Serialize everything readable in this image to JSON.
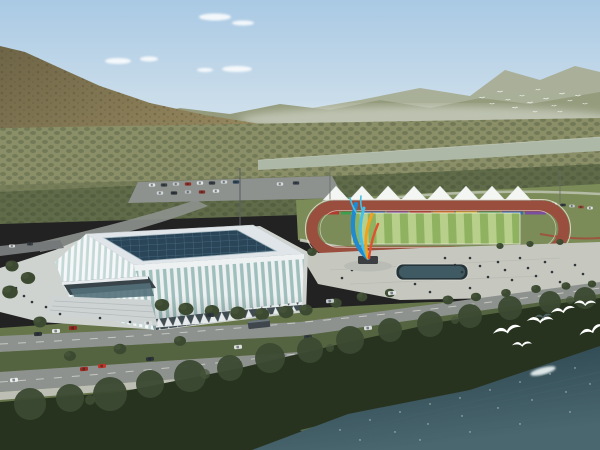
{
  "scene": {
    "type": "aerial-architectural-rendering",
    "subject": "riverside sports complex with gymnasium and outdoor stadium",
    "landmarks": [
      "ribbed-glass-gymnasium",
      "running-track-stadium",
      "white-canopy-tents",
      "flame-ribbon-sculpture",
      "public-plaza",
      "reflecting-pool",
      "parking-lot",
      "lakeside-forest"
    ],
    "environment": [
      "mountain-slope",
      "distant-ridges",
      "valley-forest",
      "river-band",
      "dark-water",
      "sky-with-clouds"
    ],
    "counts": {
      "canopy_tents": 8,
      "billboard_panels": 10,
      "foreground_seagulls": 7,
      "distant_flock_birds": 16
    }
  },
  "colors": {
    "sky_top": "#a9c9e4",
    "sky_horizon": "#edf2f1",
    "cloud": "#ffffff",
    "ridge_far": "#a8ad94",
    "ridge_near": "#959c7e",
    "mountain_light": "#97895f",
    "mountain_dark": "#6e6547",
    "valley": "#8a8f68",
    "valley_dark": "#6d7552",
    "river": "#adb8a6",
    "trees_mid": "#5f6b49",
    "lawn": "#7c8c58",
    "track": "#9a4f3e",
    "field_light": "#b7cf8a",
    "field_dark": "#8fb261",
    "tent": "#f4f6f3",
    "billboard": [
      "#b23b30",
      "#3f9e4d",
      "#2f6fb5",
      "#7a4fa0",
      "#b23b30",
      "#e0872e",
      "#d4c13a",
      "#3f9e4d",
      "#2f6fb5",
      "#7a4fa0"
    ],
    "plaza": "#c6c8c0",
    "pad": "#cfd3d0",
    "road": "#8e928e",
    "road_dark": "#75797a",
    "grass": "#66754a",
    "grass_dark": "#556440",
    "roof": "#dfe5e8",
    "skylight": "#2a4557",
    "glass": "#9fbfbc",
    "glass_light": "#c4d9d6",
    "building_white": "#eef1f2",
    "canopy": "#39444a",
    "tree": "#3c4a32",
    "tree_dark": "#27331f",
    "water": "#2e4a52",
    "water_deep": "#264049",
    "water_light": "#4a666e",
    "sparkle": "#d4e6e8",
    "sculpt_blue": "#1f8ad0",
    "sculpt_cyan": "#45c0e8",
    "sculpt_orange": "#f0a21e",
    "sculpt_red": "#e0512f",
    "bird": "#ffffff",
    "pool_rim": "#26343a",
    "pool_water": "#3f5a62",
    "people": "#31363a"
  }
}
